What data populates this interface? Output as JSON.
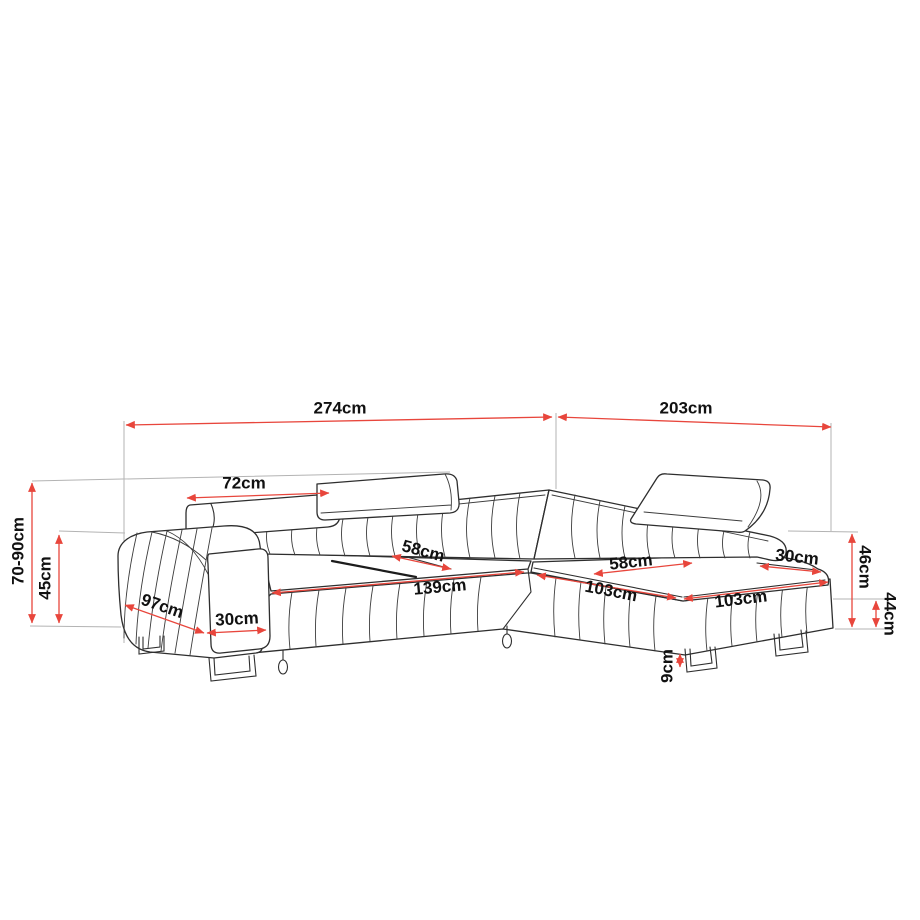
{
  "diagram": {
    "title": "corner-sofa-dimension-diagram",
    "unit": "cm",
    "colors": {
      "dimension_red": "#e8463c",
      "outline": "#2e2e2e",
      "extension_gray": "#b3b3b3",
      "label_black": "#111111",
      "background": "#ffffff"
    },
    "labels": {
      "total_width": "274cm",
      "chaise_length": "203cm",
      "headrest_width": "72cm",
      "overall_height": "70-90cm",
      "armrest_height": "45cm",
      "sofa_depth": "97cm",
      "armrest_width": "30cm",
      "seat_depth": "58cm",
      "seat_width": "139cm",
      "chaise_front_length": "103cm",
      "chaise_outer_length": "103cm",
      "chaise_seat_width": "58cm",
      "chaise_end_width": "30cm",
      "backrest_height": "46cm",
      "base_height": "44cm",
      "leg_height": "9cm"
    }
  }
}
